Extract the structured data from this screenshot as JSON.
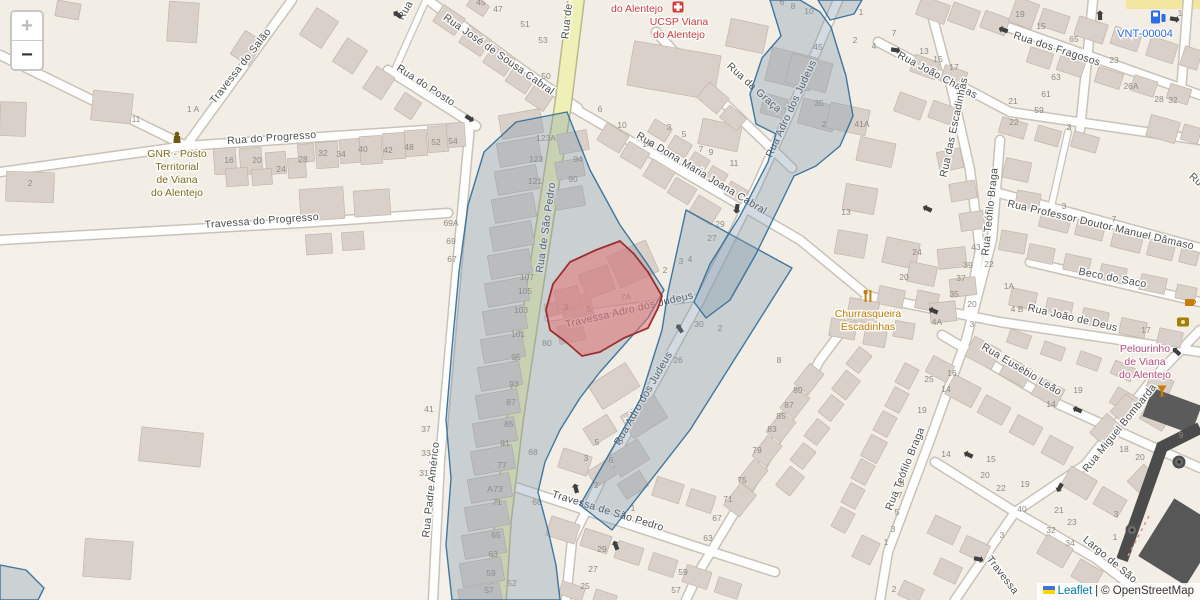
{
  "controls": {
    "zoom_in": "+",
    "zoom_out": "−"
  },
  "attribution": {
    "leaflet": "Leaflet",
    "separator": "|",
    "copyright": "© OpenStreetMap"
  },
  "colors": {
    "selection_blue_stroke": "#2f6a99",
    "selection_blue_fill": "#7e96ab",
    "selection_red_stroke": "#9c2f2f",
    "selection_red_fill": "#e57373",
    "main_road_yellow": "#eff0b6",
    "street_label": "#4e4e4e",
    "housenumber": "#8f8b80"
  },
  "map": {
    "streets": [
      {
        "name": "Travessa do Salão",
        "x": 243,
        "y": 68,
        "rot": -52
      },
      {
        "name": "Rua do Progresso",
        "x": 272,
        "y": 141,
        "rot": -4
      },
      {
        "name": "Travessa do Progresso",
        "x": 262,
        "y": 224,
        "rot": -4
      },
      {
        "name": "Rua do Posto",
        "x": 424,
        "y": 88,
        "rot": 33
      },
      {
        "name": "Rua",
        "x": 408,
        "y": 12,
        "rot": -60
      },
      {
        "name": "Rua José de Sousa Cabral",
        "x": 497,
        "y": 57,
        "rot": 35
      },
      {
        "name": "Rua de São Pedro",
        "x": 549,
        "y": 228,
        "rot": -82
      },
      {
        "name": "Rua de São Pedro",
        "x": 573,
        "y": -6,
        "rot": -84
      },
      {
        "name": "Rua Padre Américo",
        "x": 434,
        "y": 490,
        "rot": -84
      },
      {
        "name": "Travessa de São Pedro",
        "x": 607,
        "y": 514,
        "rot": 17
      },
      {
        "name": "Travessa Adro dos Judeus",
        "x": 630,
        "y": 313,
        "rot": -13
      },
      {
        "name": "Rua Adro dos Judeus",
        "x": 646,
        "y": 400,
        "rot": -60
      },
      {
        "name": "Rua Adro dos Judeus",
        "x": 794,
        "y": 110,
        "rot": -65
      },
      {
        "name": "Rua da Graça",
        "x": 752,
        "y": 90,
        "rot": 42
      },
      {
        "name": "Rua Dona Maria Joana Cabral",
        "x": 700,
        "y": 176,
        "rot": 31
      },
      {
        "name": "Rua João Chagas",
        "x": 936,
        "y": 78,
        "rot": 28
      },
      {
        "name": "Rua dos Fragosos",
        "x": 1056,
        "y": 52,
        "rot": 18
      },
      {
        "name": "Rua das Escadinhas",
        "x": 957,
        "y": 128,
        "rot": -78
      },
      {
        "name": "Rua Teófilo Braga",
        "x": 993,
        "y": 212,
        "rot": -84
      },
      {
        "name": "Rua Teófilo Braga",
        "x": 908,
        "y": 470,
        "rot": -68
      },
      {
        "name": "Rua Professor Doutor Manuel Dâmaso",
        "x": 1100,
        "y": 228,
        "rot": 13
      },
      {
        "name": "Beco do Saco",
        "x": 1112,
        "y": 281,
        "rot": 11
      },
      {
        "name": "Rua João de Deus",
        "x": 1072,
        "y": 321,
        "rot": 13
      },
      {
        "name": "Rua Eusébio Leão",
        "x": 1020,
        "y": 372,
        "rot": 31
      },
      {
        "name": "Rua Miguel Bombarda",
        "x": 1122,
        "y": 430,
        "rot": -51
      },
      {
        "name": "Largo de São",
        "x": 1108,
        "y": 562,
        "rot": 40
      },
      {
        "name": "Travessa",
        "x": 1000,
        "y": 577,
        "rot": 52
      },
      {
        "name": "Rua",
        "x": 1196,
        "y": 184,
        "rot": 42
      }
    ],
    "housenumbers": [
      {
        "t": "11",
        "x": 136,
        "y": 122
      },
      {
        "t": "1 A",
        "x": 193,
        "y": 112
      },
      {
        "t": "2",
        "x": 30,
        "y": 186
      },
      {
        "t": "16",
        "x": 229,
        "y": 163
      },
      {
        "t": "20",
        "x": 257,
        "y": 163
      },
      {
        "t": "24",
        "x": 281,
        "y": 172
      },
      {
        "t": "28",
        "x": 303,
        "y": 162
      },
      {
        "t": "32",
        "x": 323,
        "y": 156
      },
      {
        "t": "34",
        "x": 341,
        "y": 157
      },
      {
        "t": "40",
        "x": 363,
        "y": 152
      },
      {
        "t": "42",
        "x": 388,
        "y": 153
      },
      {
        "t": "48",
        "x": 409,
        "y": 150
      },
      {
        "t": "52",
        "x": 436,
        "y": 145
      },
      {
        "t": "54",
        "x": 453,
        "y": 144
      },
      {
        "t": "45",
        "x": 481,
        "y": 5
      },
      {
        "t": "47",
        "x": 498,
        "y": 12
      },
      {
        "t": "51",
        "x": 525,
        "y": 27
      },
      {
        "t": "53",
        "x": 543,
        "y": 43
      },
      {
        "t": "50",
        "x": 546,
        "y": 79
      },
      {
        "t": "69A",
        "x": 451,
        "y": 226
      },
      {
        "t": "69",
        "x": 451,
        "y": 244
      },
      {
        "t": "67",
        "x": 452,
        "y": 262
      },
      {
        "t": "123A",
        "x": 546,
        "y": 141
      },
      {
        "t": "123",
        "x": 536,
        "y": 162
      },
      {
        "t": "121",
        "x": 535,
        "y": 184
      },
      {
        "t": "94",
        "x": 578,
        "y": 162
      },
      {
        "t": "90",
        "x": 573,
        "y": 182
      },
      {
        "t": "107",
        "x": 527,
        "y": 280
      },
      {
        "t": "105",
        "x": 525,
        "y": 294
      },
      {
        "t": "103",
        "x": 521,
        "y": 313
      },
      {
        "t": "101",
        "x": 518,
        "y": 337
      },
      {
        "t": "95",
        "x": 516,
        "y": 360
      },
      {
        "t": "93",
        "x": 514,
        "y": 387
      },
      {
        "t": "87",
        "x": 511,
        "y": 405
      },
      {
        "t": "85",
        "x": 509,
        "y": 427
      },
      {
        "t": "81",
        "x": 505,
        "y": 446
      },
      {
        "t": "77",
        "x": 502,
        "y": 468
      },
      {
        "t": "73",
        "x": 498,
        "y": 492
      },
      {
        "t": "71",
        "x": 497,
        "y": 505
      },
      {
        "t": "65",
        "x": 496,
        "y": 538
      },
      {
        "t": "63",
        "x": 493,
        "y": 557
      },
      {
        "t": "59",
        "x": 491,
        "y": 576
      },
      {
        "t": "57",
        "x": 489,
        "y": 593
      },
      {
        "t": "52",
        "x": 512,
        "y": 586
      },
      {
        "t": "80",
        "x": 547,
        "y": 346
      },
      {
        "t": "68",
        "x": 533,
        "y": 455
      },
      {
        "t": "66",
        "x": 537,
        "y": 505
      },
      {
        "t": "41",
        "x": 429,
        "y": 412
      },
      {
        "t": "37",
        "x": 426,
        "y": 432
      },
      {
        "t": "33",
        "x": 426,
        "y": 456
      },
      {
        "t": "31",
        "x": 424,
        "y": 476
      },
      {
        "t": "3",
        "x": 566,
        "y": 310
      },
      {
        "t": "5",
        "x": 589,
        "y": 312
      },
      {
        "t": "7A",
        "x": 626,
        "y": 300
      },
      {
        "t": "29",
        "x": 720,
        "y": 227
      },
      {
        "t": "27",
        "x": 712,
        "y": 241
      },
      {
        "t": "2",
        "x": 665,
        "y": 273
      },
      {
        "t": "3",
        "x": 681,
        "y": 264
      },
      {
        "t": "4",
        "x": 690,
        "y": 262
      },
      {
        "t": "1",
        "x": 683,
        "y": 303
      },
      {
        "t": "30",
        "x": 699,
        "y": 327
      },
      {
        "t": "2",
        "x": 720,
        "y": 331
      },
      {
        "t": "26",
        "x": 678,
        "y": 363
      },
      {
        "t": "8",
        "x": 779,
        "y": 363
      },
      {
        "t": "13",
        "x": 846,
        "y": 215
      },
      {
        "t": "5",
        "x": 597,
        "y": 445
      },
      {
        "t": "8",
        "x": 621,
        "y": 444
      },
      {
        "t": "3",
        "x": 586,
        "y": 461
      },
      {
        "t": "6",
        "x": 611,
        "y": 463
      },
      {
        "t": "2",
        "x": 596,
        "y": 488
      },
      {
        "t": "1",
        "x": 633,
        "y": 511
      },
      {
        "t": "A",
        "x": 490,
        "y": 492
      },
      {
        "t": "29",
        "x": 602,
        "y": 552
      },
      {
        "t": "27",
        "x": 593,
        "y": 572
      },
      {
        "t": "25",
        "x": 585,
        "y": 589
      },
      {
        "t": "89",
        "x": 798,
        "y": 393
      },
      {
        "t": "87",
        "x": 789,
        "y": 408
      },
      {
        "t": "85",
        "x": 781,
        "y": 419
      },
      {
        "t": "83",
        "x": 772,
        "y": 432
      },
      {
        "t": "79",
        "x": 757,
        "y": 453
      },
      {
        "t": "75",
        "x": 742,
        "y": 483
      },
      {
        "t": "71",
        "x": 728,
        "y": 502
      },
      {
        "t": "67",
        "x": 717,
        "y": 521
      },
      {
        "t": "63",
        "x": 708,
        "y": 541
      },
      {
        "t": "59",
        "x": 683,
        "y": 575
      },
      {
        "t": "57",
        "x": 676,
        "y": 593
      },
      {
        "t": "9",
        "x": 902,
        "y": 487
      },
      {
        "t": "7",
        "x": 900,
        "y": 498
      },
      {
        "t": "5",
        "x": 897,
        "y": 515
      },
      {
        "t": "3",
        "x": 893,
        "y": 532
      },
      {
        "t": "1",
        "x": 886,
        "y": 545
      },
      {
        "t": "2",
        "x": 894,
        "y": 592
      },
      {
        "t": "25",
        "x": 929,
        "y": 382
      },
      {
        "t": "14",
        "x": 946,
        "y": 392
      },
      {
        "t": "19",
        "x": 922,
        "y": 413
      },
      {
        "t": "14",
        "x": 946,
        "y": 457
      },
      {
        "t": "15",
        "x": 991,
        "y": 462
      },
      {
        "t": "20",
        "x": 985,
        "y": 478
      },
      {
        "t": "22",
        "x": 1001,
        "y": 491
      },
      {
        "t": "19",
        "x": 1025,
        "y": 487
      },
      {
        "t": "40",
        "x": 1022,
        "y": 512
      },
      {
        "t": "21",
        "x": 1059,
        "y": 513
      },
      {
        "t": "23",
        "x": 1072,
        "y": 525
      },
      {
        "t": "32",
        "x": 1051,
        "y": 533
      },
      {
        "t": "34",
        "x": 1070,
        "y": 546
      },
      {
        "t": "3",
        "x": 1002,
        "y": 538
      },
      {
        "t": "24",
        "x": 917,
        "y": 255
      },
      {
        "t": "20",
        "x": 904,
        "y": 280
      },
      {
        "t": "43",
        "x": 976,
        "y": 250
      },
      {
        "t": "39",
        "x": 968,
        "y": 268
      },
      {
        "t": "37",
        "x": 961,
        "y": 281
      },
      {
        "t": "35",
        "x": 954,
        "y": 297
      },
      {
        "t": "22",
        "x": 989,
        "y": 267
      },
      {
        "t": "1A",
        "x": 1009,
        "y": 289
      },
      {
        "t": "20",
        "x": 972,
        "y": 307
      },
      {
        "t": "4 B",
        "x": 1017,
        "y": 312
      },
      {
        "t": "4A",
        "x": 937,
        "y": 325
      },
      {
        "t": "3",
        "x": 972,
        "y": 327
      },
      {
        "t": "3",
        "x": 1064,
        "y": 209
      },
      {
        "t": "7",
        "x": 1114,
        "y": 222
      },
      {
        "t": "19",
        "x": 1020,
        "y": 17
      },
      {
        "t": "15",
        "x": 1041,
        "y": 29
      },
      {
        "t": "65",
        "x": 1074,
        "y": 42
      },
      {
        "t": "23",
        "x": 1114,
        "y": 63
      },
      {
        "t": "13",
        "x": 924,
        "y": 54
      },
      {
        "t": "15",
        "x": 938,
        "y": 62
      },
      {
        "t": "17",
        "x": 954,
        "y": 70
      },
      {
        "t": "63",
        "x": 1056,
        "y": 80
      },
      {
        "t": "61",
        "x": 1046,
        "y": 97
      },
      {
        "t": "59",
        "x": 1039,
        "y": 113
      },
      {
        "t": "21",
        "x": 1013,
        "y": 104
      },
      {
        "t": "22",
        "x": 1014,
        "y": 125
      },
      {
        "t": "26A",
        "x": 1131,
        "y": 89
      },
      {
        "t": "28",
        "x": 1159,
        "y": 102
      },
      {
        "t": "32",
        "x": 1173,
        "y": 103
      },
      {
        "t": "3",
        "x": 1069,
        "y": 130
      },
      {
        "t": "1",
        "x": 1180,
        "y": 16
      },
      {
        "t": "6",
        "x": 782,
        "y": 5
      },
      {
        "t": "8",
        "x": 793,
        "y": 9
      },
      {
        "t": "10",
        "x": 809,
        "y": 14
      },
      {
        "t": "45",
        "x": 818,
        "y": 50
      },
      {
        "t": "35",
        "x": 819,
        "y": 106
      },
      {
        "t": "41A",
        "x": 862,
        "y": 127
      },
      {
        "t": "1",
        "x": 861,
        "y": 15
      },
      {
        "t": "7",
        "x": 894,
        "y": 36
      },
      {
        "t": "2",
        "x": 855,
        "y": 43
      },
      {
        "t": "4",
        "x": 874,
        "y": 49
      },
      {
        "t": "2",
        "x": 824,
        "y": 127
      },
      {
        "t": "6",
        "x": 600,
        "y": 112
      },
      {
        "t": "10",
        "x": 622,
        "y": 128
      },
      {
        "t": "14",
        "x": 647,
        "y": 147
      },
      {
        "t": "3",
        "x": 669,
        "y": 130
      },
      {
        "t": "5",
        "x": 684,
        "y": 137
      },
      {
        "t": "7",
        "x": 701,
        "y": 152
      },
      {
        "t": "9",
        "x": 711,
        "y": 155
      },
      {
        "t": "11",
        "x": 734,
        "y": 166
      },
      {
        "t": "17",
        "x": 1146,
        "y": 333
      },
      {
        "t": "16",
        "x": 952,
        "y": 376
      },
      {
        "t": "19",
        "x": 1078,
        "y": 393
      },
      {
        "t": "14",
        "x": 1051,
        "y": 407
      },
      {
        "t": "9",
        "x": 1181,
        "y": 438
      },
      {
        "t": "18",
        "x": 1124,
        "y": 452
      },
      {
        "t": "20",
        "x": 1140,
        "y": 460
      },
      {
        "t": "3",
        "x": 1116,
        "y": 517
      },
      {
        "t": "1",
        "x": 1115,
        "y": 540
      }
    ],
    "pois": [
      {
        "id": "gnr",
        "icon": "police",
        "ix": 177,
        "iy": 139,
        "color": "#806b1f",
        "x": 177,
        "y": 157,
        "lh": 13,
        "lines": [
          "GNR - Posto",
          "Territorial",
          "de Viana",
          "do Alentejo"
        ]
      },
      {
        "id": "clinic-partial",
        "icon": "none",
        "ix": 0,
        "iy": 0,
        "color": "#cc3b3b",
        "x": 637,
        "y": 12,
        "lh": 12,
        "lines": [
          "do Alentejo"
        ]
      },
      {
        "id": "ucsp",
        "icon": "clinic",
        "ix": 678,
        "iy": 7,
        "color": "#cc3b3b",
        "x": 679,
        "y": 25,
        "lh": 13,
        "lines": [
          "UCSP Viana",
          "do Alentejo"
        ]
      },
      {
        "id": "vnt",
        "icon": "charging",
        "ix": 1158,
        "iy": 17,
        "color": "#2e6be6",
        "x": 1145,
        "y": 37,
        "lh": 12,
        "lines": [
          "VNT-00004"
        ]
      },
      {
        "id": "churrasqueira",
        "icon": "restaurant",
        "ix": 868,
        "iy": 296,
        "color": "#bf7d05",
        "x": 868,
        "y": 317,
        "lh": 13,
        "lines": [
          "Churrasqueira",
          "Escadinhas"
        ]
      },
      {
        "id": "pelourinho",
        "icon": "bar",
        "ix": 1162,
        "iy": 391,
        "color": "#b34d7a",
        "x": 1145,
        "y": 352,
        "lh": 13,
        "lines": [
          "Pelourinho",
          "de Viana",
          "do Alentejo"
        ]
      },
      {
        "id": "cafe",
        "icon": "cafe",
        "ix": 1190,
        "iy": 303,
        "color": "#c77d0a",
        "x": 1190,
        "y": 316,
        "lh": 12,
        "lines": []
      },
      {
        "id": "viewpoint",
        "icon": "gold",
        "ix": 1183,
        "iy": 322,
        "color": "#a08008",
        "x": 1183,
        "y": 334,
        "lh": 12,
        "lines": []
      }
    ],
    "markers": [
      {
        "id": "monument-circle",
        "x": 1179,
        "y": 462
      },
      {
        "id": "monument-circle",
        "x": 1132,
        "y": 530
      }
    ]
  }
}
